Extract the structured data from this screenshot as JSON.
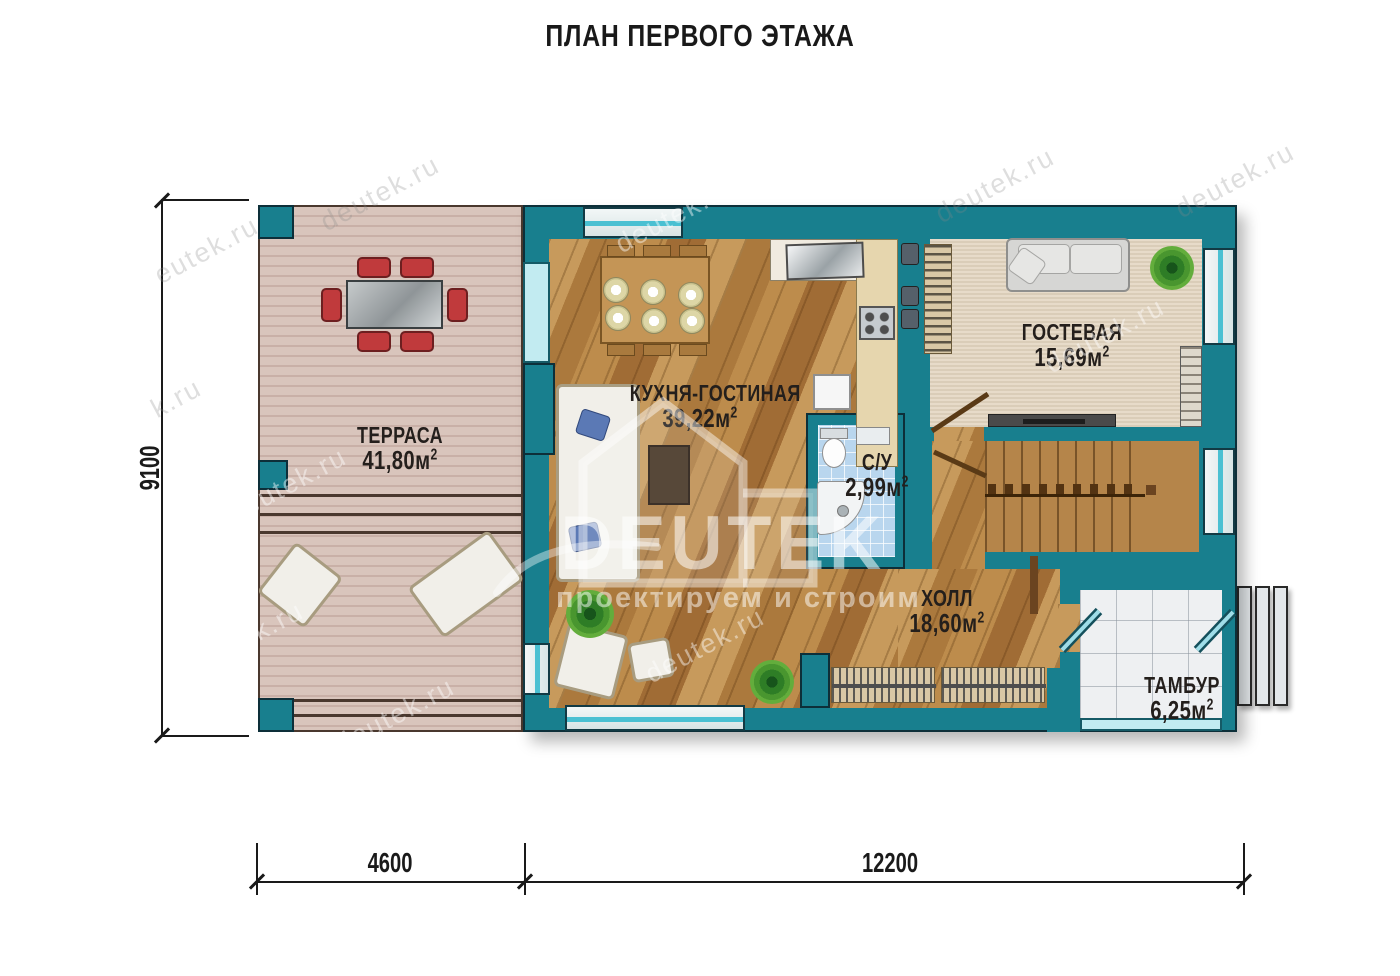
{
  "title": "ПЛАН ПЕРВОГО ЭТАЖА",
  "units": {
    "m": "м",
    "sup": "2"
  },
  "rooms": {
    "terrace": {
      "name": "ТЕРРАСА",
      "area": "41,80"
    },
    "kitchen_living": {
      "name": "КУХНЯ-ГОСТИНАЯ",
      "area": "39,22"
    },
    "guest": {
      "name": "ГОСТЕВАЯ",
      "area": "15,69"
    },
    "bathroom": {
      "name": "С/У",
      "area": "2,99"
    },
    "hall": {
      "name": "ХОЛЛ",
      "area": "18,60"
    },
    "vestibule": {
      "name": "ТАМБУР",
      "area": "6,25"
    }
  },
  "dimensions": {
    "height_mm": "9100",
    "terrace_width_mm": "4600",
    "house_width_mm": "12200"
  },
  "watermark": {
    "site": "deutek.ru",
    "site_short": "eutek.ru",
    "site_frag": "k.ru",
    "logo": "DEUTEK",
    "tagline": "проектируем и строим"
  },
  "colors": {
    "wall": "#187f8e",
    "wall-outline": "#0d2f39",
    "deck": "#d9c5bc",
    "deck-line": "#c9b0a7",
    "wood": "#b8864a",
    "carpet": "#e7dbc9",
    "tile": "#b9d6ee",
    "marble": "#eef0f2",
    "window-accent": "#4ac0d2",
    "chair-red": "#c03a3c",
    "stairs": "#b5854a",
    "counter": "#e6d6ae",
    "label-ink": "#241f1c",
    "dim-ink": "#1a1a1a",
    "watermark-gray": "rgba(135,135,135,0.28)",
    "watermark-white": "rgba(255,255,255,0.45)"
  }
}
